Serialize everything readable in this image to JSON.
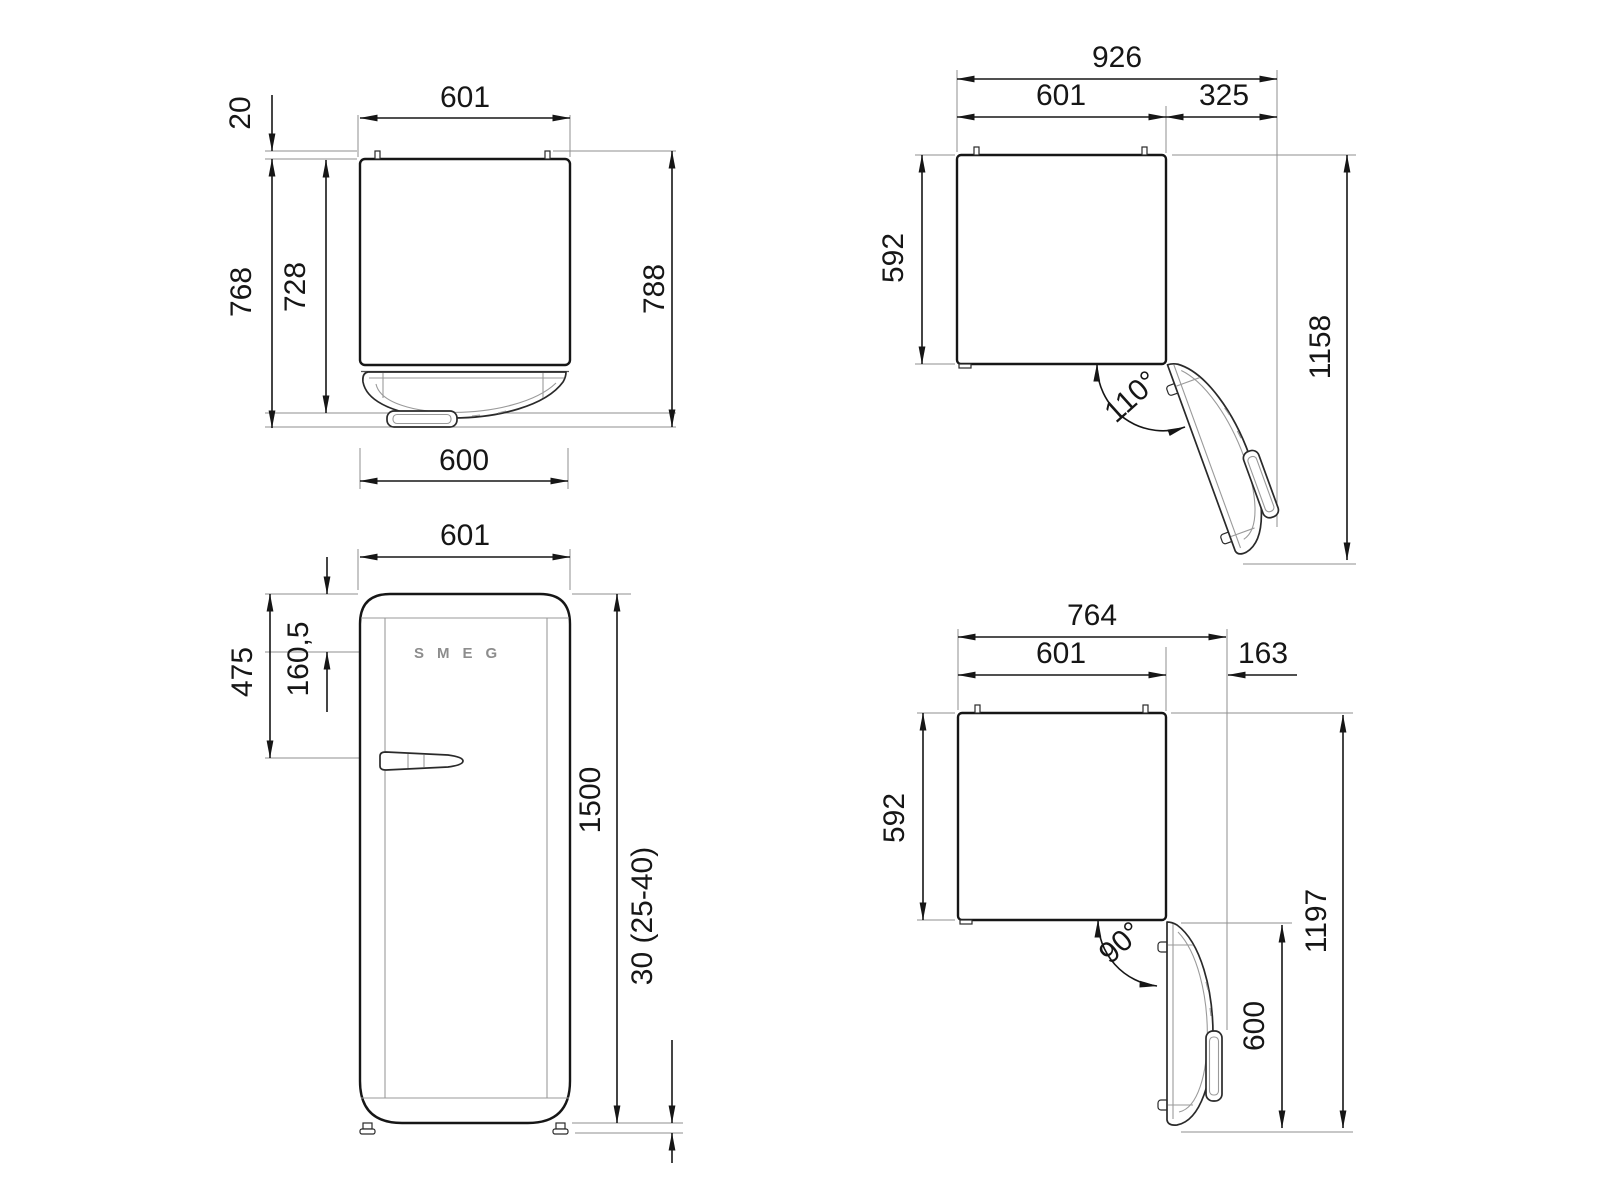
{
  "page": {
    "background": "#ffffff",
    "line_color": "#161616"
  },
  "drawing": {
    "views": {
      "top_closed": {
        "dims": {
          "width": "601",
          "rear_spacer": "20",
          "depth_to_handle": "768",
          "depth_to_door": "728",
          "depth_overall": "788",
          "door_width": "600"
        }
      },
      "top_open_110": {
        "dims": {
          "overall_width": "926",
          "body_width": "601",
          "door_projection": "325",
          "body_depth": "592",
          "overall_depth": "1158",
          "opening_angle": "110°"
        }
      },
      "front": {
        "logo": "SMEG",
        "dims": {
          "width": "601",
          "logo_offset": "160,5",
          "handle_offset": "475",
          "height": "1500",
          "feet_height": "30 (25-40)"
        }
      },
      "top_open_90": {
        "dims": {
          "overall_width": "764",
          "body_width": "601",
          "door_projection": "163",
          "body_depth": "592",
          "overall_depth": "1197",
          "door_width": "600",
          "opening_angle": "90°"
        }
      }
    }
  }
}
